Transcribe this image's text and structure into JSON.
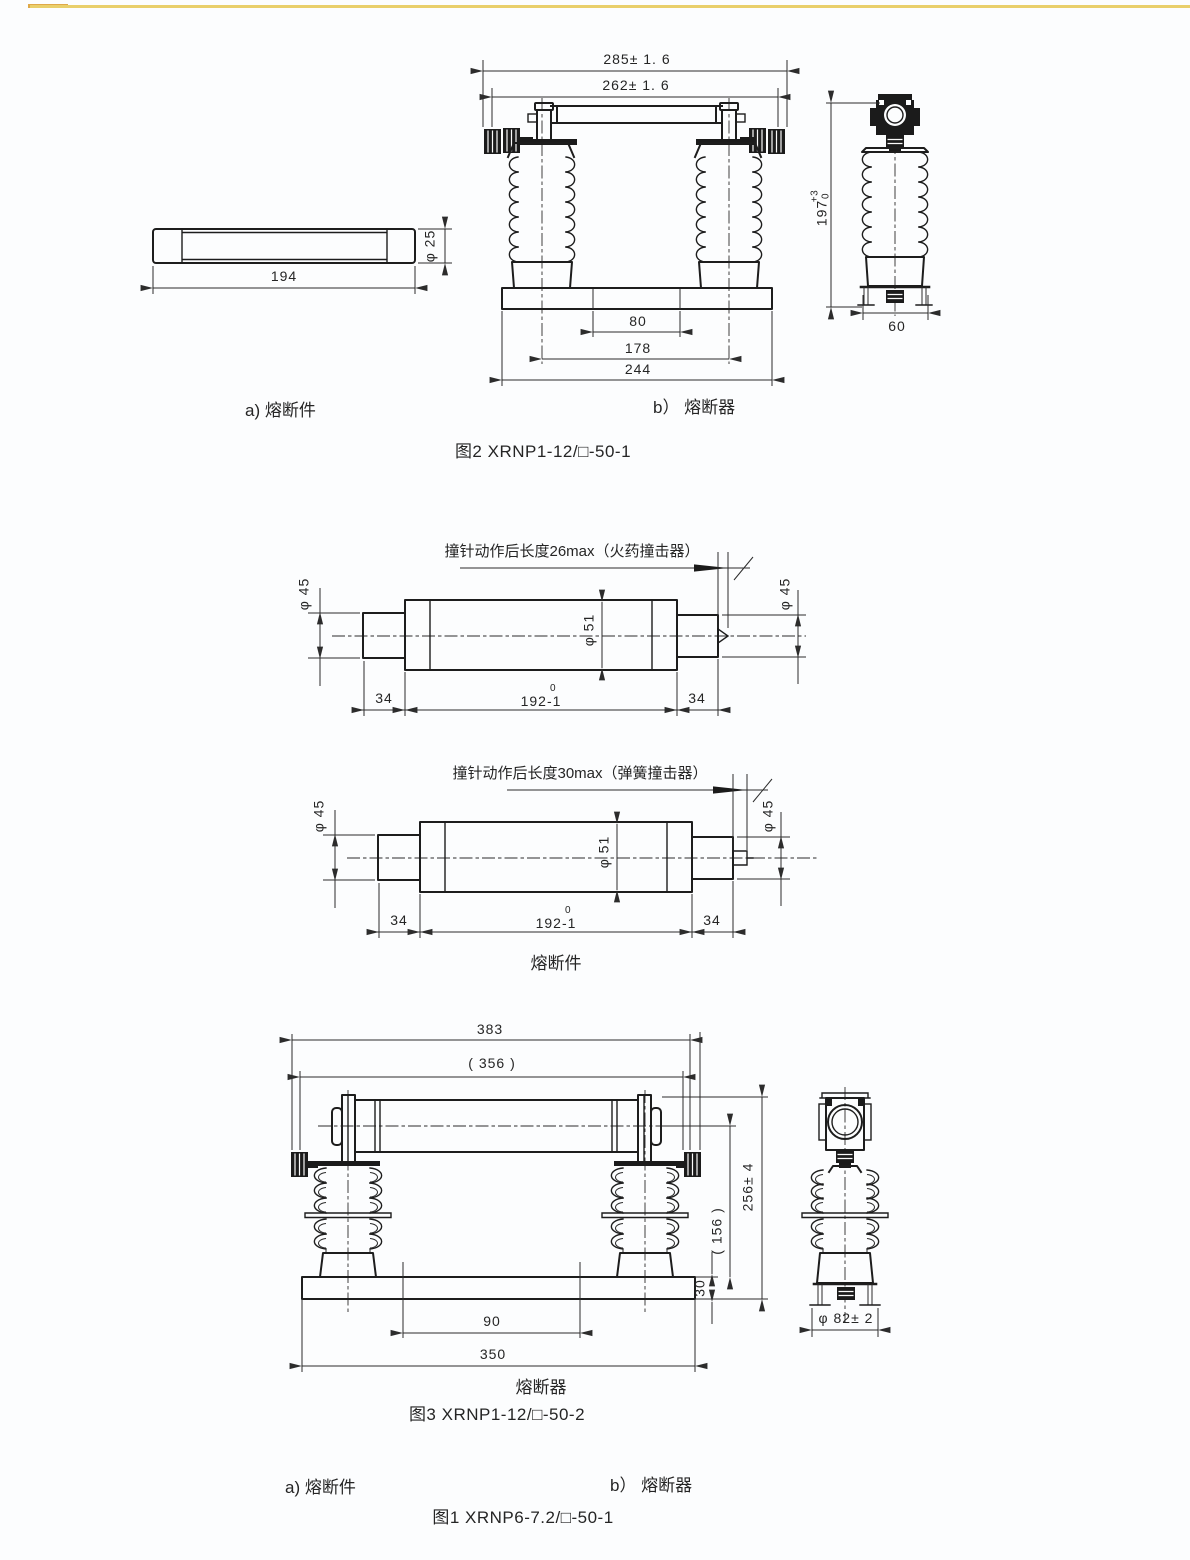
{
  "accents": {
    "top_rule": "#e9cf6b",
    "top_rule_tip": "#dfa949",
    "ink": "#252525"
  },
  "fig2": {
    "caption": "图2  XRNP1-12/□-50-1",
    "label_a": "a) 熔断件",
    "label_b": "b） 熔断器",
    "fuse_link": {
      "dim_length": "194",
      "dim_dia": "φ 25"
    },
    "assembly": {
      "dim_overall": "285± 1. 6",
      "dim_inner": "262± 1. 6",
      "dim_hole": "80",
      "dim_centers": "178",
      "dim_base": "244"
    },
    "side": {
      "dim_height": "197",
      "tol_plus": "+3",
      "tol_zero": "0",
      "dim_width": "60"
    }
  },
  "links": {
    "note_powder": "撞针动作后长度26max（火药撞击器）",
    "note_spring": "撞针动作后长度30max（弹簧撞击器）",
    "dia_end": "φ 45",
    "dia_body": "φ 51",
    "dim_cap": "34",
    "dim_body": "192-1",
    "dim_body_tol": "0",
    "label": "熔断件"
  },
  "fig3": {
    "caption": "图3 XRNP1-12/□-50-2",
    "label": "熔断器",
    "dims": {
      "overall": "383",
      "inner": "( 356 )",
      "height": "256± 4",
      "mid": "( 156 )",
      "base_h": "30",
      "holes": "90",
      "base_w": "350",
      "dia": "φ 82± 2"
    }
  },
  "footer": {
    "label_a": "a) 熔断件",
    "label_b": "b） 熔断器",
    "caption": "图1 XRNP6-7.2/□-50-1"
  }
}
